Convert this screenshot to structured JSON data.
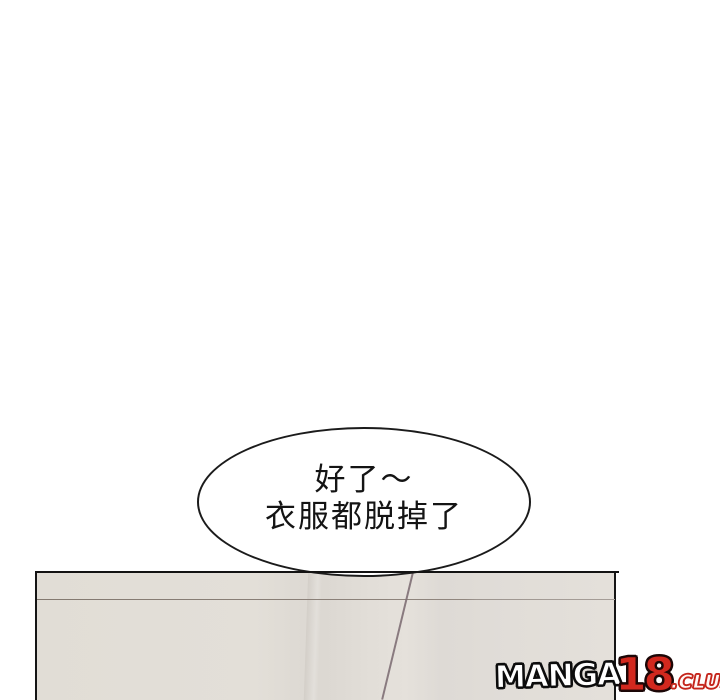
{
  "comic_page": {
    "background_color": "#ffffff"
  },
  "speech_bubble": {
    "lines": {
      "0": "好了～",
      "1": "衣服都脱掉了"
    },
    "fill_color": "#ffffff",
    "outline_color": "#1b1b1b",
    "text_color": "#141414"
  },
  "panel": {
    "background_color": "#e3dfd8",
    "border_color": "#151515",
    "wall_seam_color": "#8a8078",
    "corner_seam_color": "#7e6f74"
  },
  "watermark": {
    "full_text": "MANGA18.CLUB",
    "part_manga": "MANGA",
    "part_num": "18",
    "part_club": ".CLUB",
    "manga_fill": "#ffffff",
    "manga_outline": "#0d0d0d",
    "num_fill": "#d2281e",
    "num_outline": "#1a0707",
    "club_fill": "#fff7f5",
    "club_outline": "#c4241b"
  }
}
